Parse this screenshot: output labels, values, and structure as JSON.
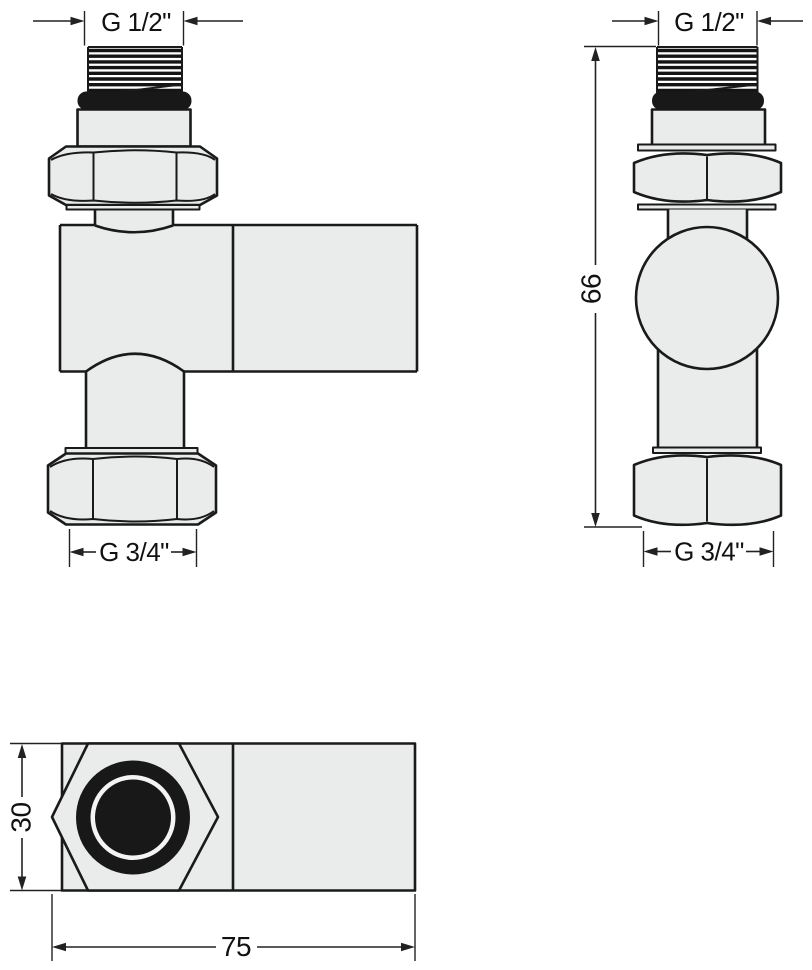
{
  "drawing": {
    "background": "#ffffff",
    "line_color": "#1a1a1a",
    "body_fill": "#eaebeb",
    "seal_fill": "#181818",
    "labels": {
      "angle_top_thread": "G 1/2\"",
      "angle_bottom_thread": "G 3/4\"",
      "straight_top_thread": "G 1/2\"",
      "straight_bottom_thread": "G 3/4\"",
      "straight_height": "66",
      "plan_width": "30",
      "plan_length": "75"
    }
  }
}
